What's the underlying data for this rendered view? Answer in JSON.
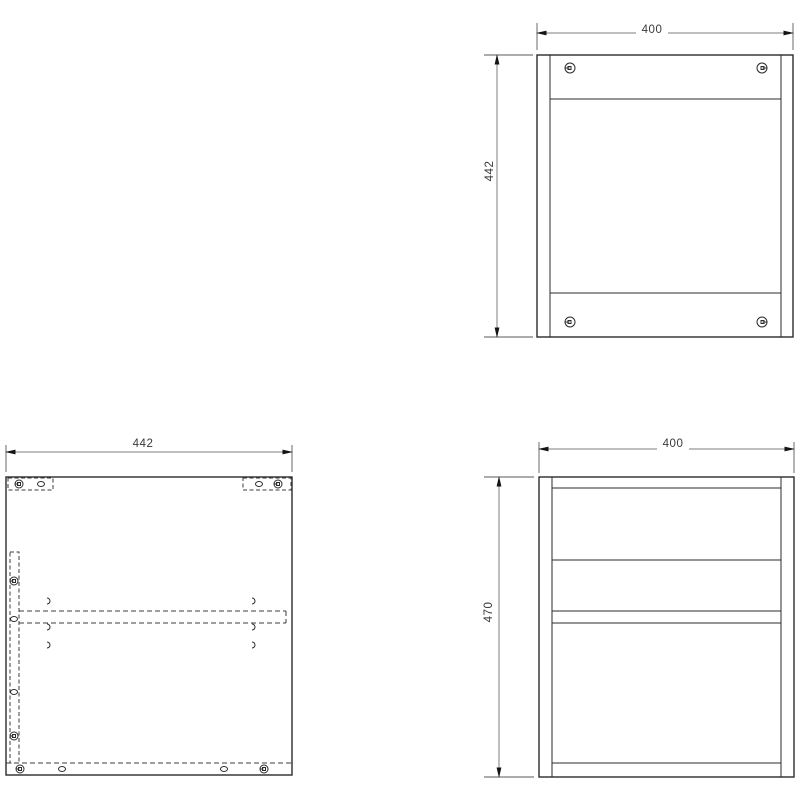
{
  "drawing": {
    "colors": {
      "background": "#ffffff",
      "object_line": "#2b2b2b",
      "hidden_line": "#3c3c3c",
      "dimension_line": "#7d7d7d",
      "dimension_text": "#3a3a3a"
    },
    "views": {
      "top_view": {
        "width_label": "400",
        "height_label": "442"
      },
      "side_panel_view": {
        "width_label": "442"
      },
      "front_view": {
        "width_label": "400",
        "height_label": "470"
      }
    },
    "icons": {
      "cam_lock_icon": "circle with square notch",
      "dowel_icon": "small ellipse outline",
      "pilot_hole_icon": "small open arc"
    }
  }
}
